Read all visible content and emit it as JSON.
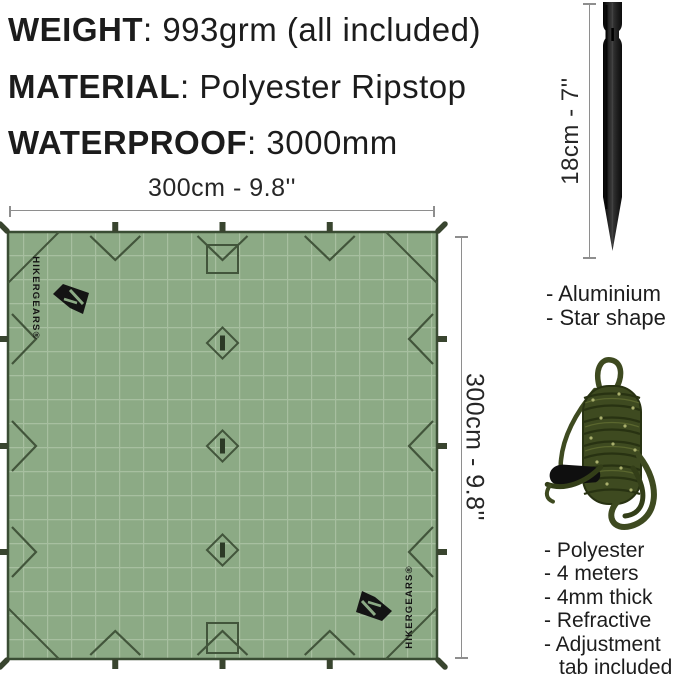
{
  "specs": {
    "separator": ": ",
    "items": [
      {
        "label": "WEIGHT",
        "value": "993grm (all included)"
      },
      {
        "label": "MATERIAL",
        "value": "Polyester Ripstop"
      },
      {
        "label": "WATERPROOF",
        "value": "3000mm"
      }
    ]
  },
  "tarp": {
    "width_label": "300cm - 9.8''",
    "height_label": "300cm - 9.8''",
    "brand": "HIKERGEARS®",
    "fabric_color": "#8caa85",
    "grid_color": "#a7bfa0",
    "detail_color": "#42553b"
  },
  "stake": {
    "length_label": "18cm - 7''",
    "color": "#1b1b1b",
    "features": [
      "- Aluminium",
      "- Star shape"
    ]
  },
  "rope": {
    "color": "#3e4a20",
    "features": [
      "- Polyester",
      "- 4 meters",
      "- 4mm thick",
      "- Refractive",
      "- Adjustment",
      "tab included"
    ]
  }
}
